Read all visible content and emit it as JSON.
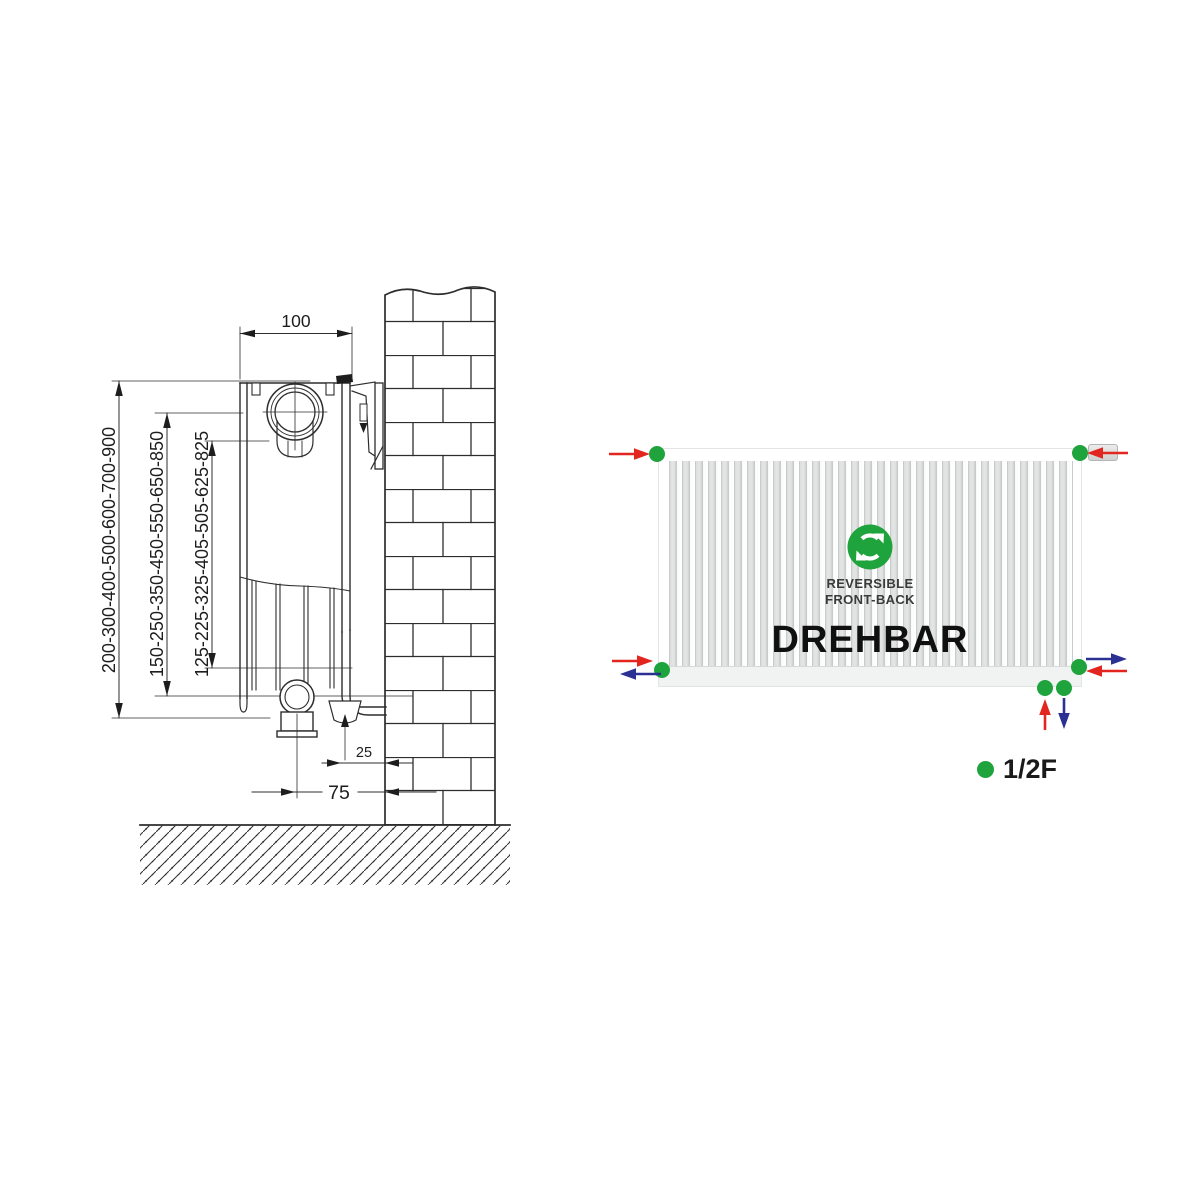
{
  "left_diagram": {
    "width_label": "100",
    "wall_gap_label": "25",
    "floor_gap_label": "75",
    "height_labels": [
      "200-300-400-500-600-700-900",
      "150-250-350-450-550-650-850",
      "125-225-325-405-505-625-825"
    ]
  },
  "right_diagram": {
    "badge_line1": "REVERSIBLE",
    "badge_line2": "FRONT-BACK",
    "title": "DREHBAR",
    "legend_label": "1/2F",
    "icons": {
      "center": "cycle-arrows-icon",
      "connection_points": "green-dot",
      "flow_in": "red-arrow",
      "flow_out": "blue-arrow"
    },
    "colors": {
      "green": "#1fa33c",
      "red": "#e3251f",
      "blue": "#2b3193"
    }
  }
}
